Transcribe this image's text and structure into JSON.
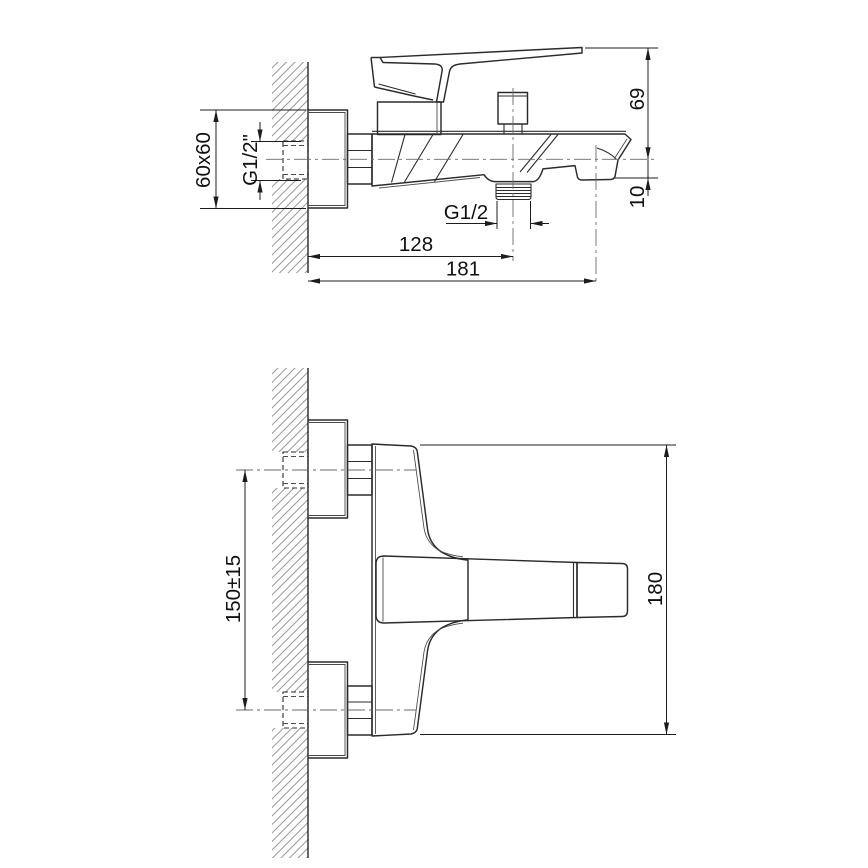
{
  "page": {
    "background": "#ffffff"
  },
  "drawing": {
    "line_color": "#2b2b2b",
    "dim_color": "#1c1c1c",
    "hatch_color": "#9a9a9a",
    "side_view": {
      "flange_size": "60x60",
      "wall_thread": "G1/2\"",
      "axis_to_lever_top": "69",
      "axis_to_spout_bottom": "10",
      "shower_outlet_thread": "G1/2",
      "wall_to_outlet_center": "128",
      "wall_to_spout_center": "181"
    },
    "plan_view": {
      "connection_spacing": "150±15",
      "overall_width": "180"
    }
  }
}
